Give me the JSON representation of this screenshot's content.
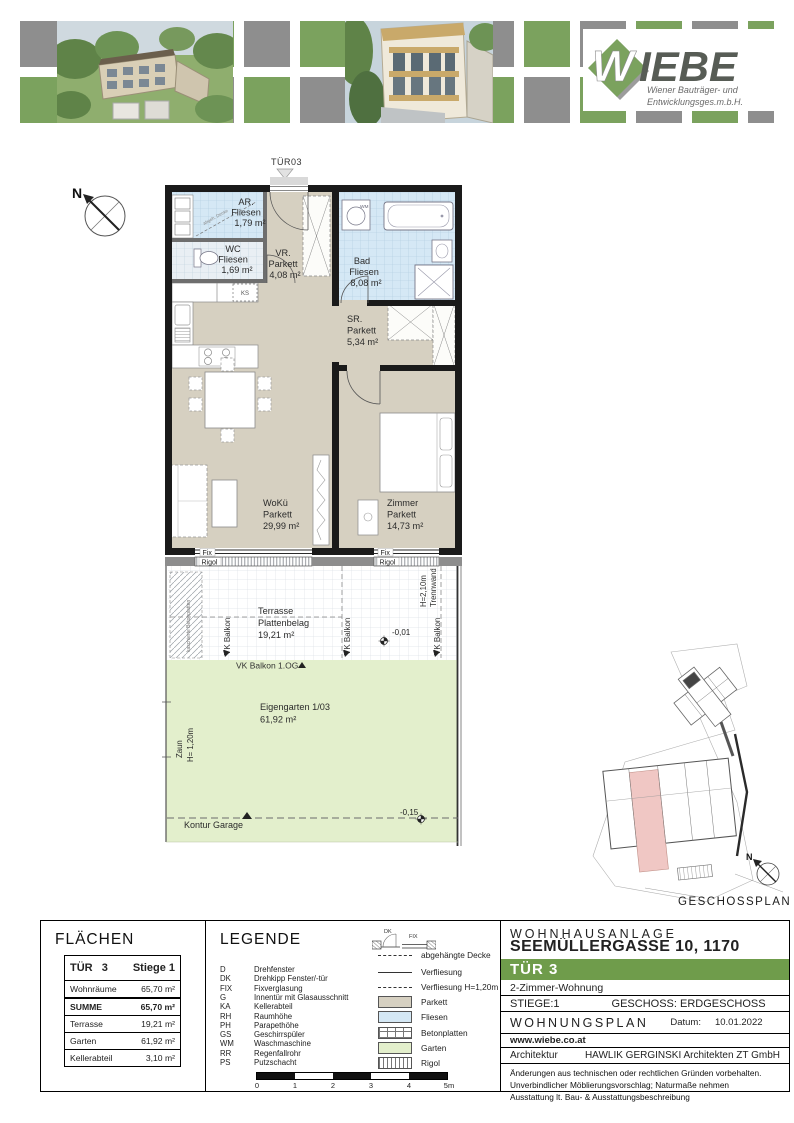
{
  "colors": {
    "green": "#6f9c4b",
    "checker_green": "#7ba25e",
    "checker_gray": "#8e8e8e",
    "parkett": "#d6d0c1",
    "fliesen": "#d5e8f5",
    "garten": "#e3efcc",
    "highlight_unit": "#f0c7c4"
  },
  "header": {
    "brand": "WIEBE",
    "tagline1": "Wiener Bauträger- und",
    "tagline2": "Entwicklungsges.m.b.H."
  },
  "plan": {
    "entry_label": "TÜR03",
    "compass_n": "N",
    "siteplan_label": "GESCHOSSPLAN",
    "rooms": {
      "ar": {
        "name": "AR.",
        "floor": "Fliesen",
        "area": "1,79 m²"
      },
      "wc": {
        "name": "WC",
        "floor": "Fliesen",
        "area": "1,69 m²"
      },
      "vr": {
        "name": "VR.",
        "floor": "Parkett",
        "area": "4,08 m²"
      },
      "bad": {
        "name": "Bad",
        "floor": "Fliesen",
        "area": "8,08 m²"
      },
      "sr": {
        "name": "SR.",
        "floor": "Parkett",
        "area": "5,34 m²"
      },
      "woku": {
        "name": "WoKü",
        "floor": "Parkett",
        "area": "29,99 m²"
      },
      "zimmer": {
        "name": "Zimmer",
        "floor": "Parkett",
        "area": "14,73 m²"
      }
    },
    "labels": {
      "fix": "Fix",
      "rigol": "Rigol",
      "terrasse_name": "Terrasse",
      "terrasse_floor": "Plattenbelag",
      "terrasse_area": "19,21 m²",
      "vk_balkon": "VK Balkon",
      "vk_balkon_og": "VK Balkon 1.OG",
      "elev_terrasse": "-0,01",
      "elev_garten": "-0,15",
      "trennwand": "Trennwand",
      "trennwand_h": "H=2,10m",
      "garten_name": "Eigengarten 1/03",
      "garten_area": "61,92 m²",
      "zaun": "Zaun",
      "zaun_h": "H= 1,20m",
      "kontur": "Kontur Garage",
      "ks": "KS",
      "wm": "WM",
      "abgeh": "abgeh. Decke",
      "betonstrip": "kaschierte Betonplatten"
    }
  },
  "flaechen": {
    "title": "FLÄCHEN",
    "unit": "TÜR   3",
    "stiege": "Stiege 1",
    "rows": [
      {
        "label": "Wohnräume",
        "value": "65,70 m²"
      },
      {
        "label": "SUMME",
        "value": "65,70 m²"
      },
      {
        "label": "Terrasse",
        "value": "19,21 m²"
      },
      {
        "label": "Garten",
        "value": "61,92 m²"
      },
      {
        "label": "Kellerabteil",
        "value": "3,10 m²"
      }
    ]
  },
  "legend": {
    "title": "LEGENDE",
    "abbreviations": [
      {
        "abbr": "D",
        "label": "Drehfenster"
      },
      {
        "abbr": "DK",
        "label": "Drehkipp Fenster/-tür"
      },
      {
        "abbr": "FIX",
        "label": "Fixverglasung"
      },
      {
        "abbr": "G",
        "label": "Innentür mit Glasausschnitt"
      },
      {
        "abbr": "KA",
        "label": "Kellerabteil"
      },
      {
        "abbr": "RH",
        "label": "Raumhöhe"
      },
      {
        "abbr": "PH",
        "label": "Parapethöhe"
      },
      {
        "abbr": "GS",
        "label": "Geschirrspüler"
      },
      {
        "abbr": "WM",
        "label": "Waschmaschine"
      },
      {
        "abbr": "RR",
        "label": "Regenfallrohr"
      },
      {
        "abbr": "PS",
        "label": "Putzschacht"
      }
    ],
    "door_symbol": {
      "dk": "DK",
      "fix": "FIX"
    },
    "lines": [
      {
        "label": "abgehängte Decke"
      },
      {
        "label": "Verfliesung"
      },
      {
        "label": "Verfliesung H=1,20m"
      }
    ],
    "surfaces": [
      {
        "label": "Parkett"
      },
      {
        "label": "Fliesen"
      },
      {
        "label": "Betonplatten"
      },
      {
        "label": "Garten"
      },
      {
        "label": "Rigol"
      }
    ],
    "scale_ticks": [
      "0",
      "1",
      "2",
      "3",
      "4",
      "5m"
    ]
  },
  "titleblock": {
    "project": "WOHNHAUSANLAGE",
    "address": "SEEMÜLLERGASSE 10, 1170 Wien",
    "unit": "TÜR 3",
    "apartment_type": "2-Zimmer-Wohnung",
    "stiege": "STIEGE:1",
    "geschoss": "GESCHOSS: ERDGESCHOSS",
    "plan_type": "WOHNUNGSPLAN",
    "date_label": "Datum:",
    "date": "10.01.2022",
    "website": "www.wiebe.co.at",
    "arch_label": "Architektur",
    "architect": "HAWLIK GERGINSKI Architekten ZT GmbH",
    "notes": [
      "Änderungen aus technischen oder rechtlichen Gründen vorbehalten.",
      "Unverbindlicher Möblierungsvorschlag; Naturmaße nehmen",
      "Ausstattung lt. Bau- & Ausstattungsbeschreibung"
    ]
  }
}
